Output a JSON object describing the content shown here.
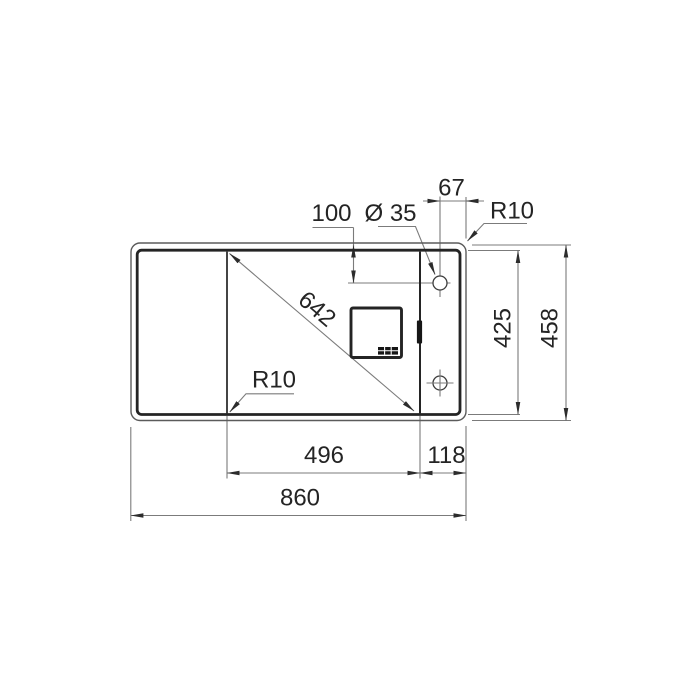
{
  "drawing": {
    "labels": {
      "hole_edge_offset": "67",
      "outer_corner_radius": "R10",
      "hole_top_offset": "100",
      "hole_diameter": "Ø 35",
      "bowl_diagonal": "642",
      "bowl_corner_radius": "R10",
      "inner_depth": "425",
      "overall_depth": "458",
      "bowl_width": "496",
      "right_ledge_width": "118",
      "overall_width": "860"
    },
    "colors": {
      "background": "#ffffff",
      "outline_thick": "#242424",
      "outline_thin": "#5b5b5b",
      "dimension_lines": "#7b7b7b",
      "arrowheads": "#2c2c2c",
      "text": "#242424"
    }
  }
}
